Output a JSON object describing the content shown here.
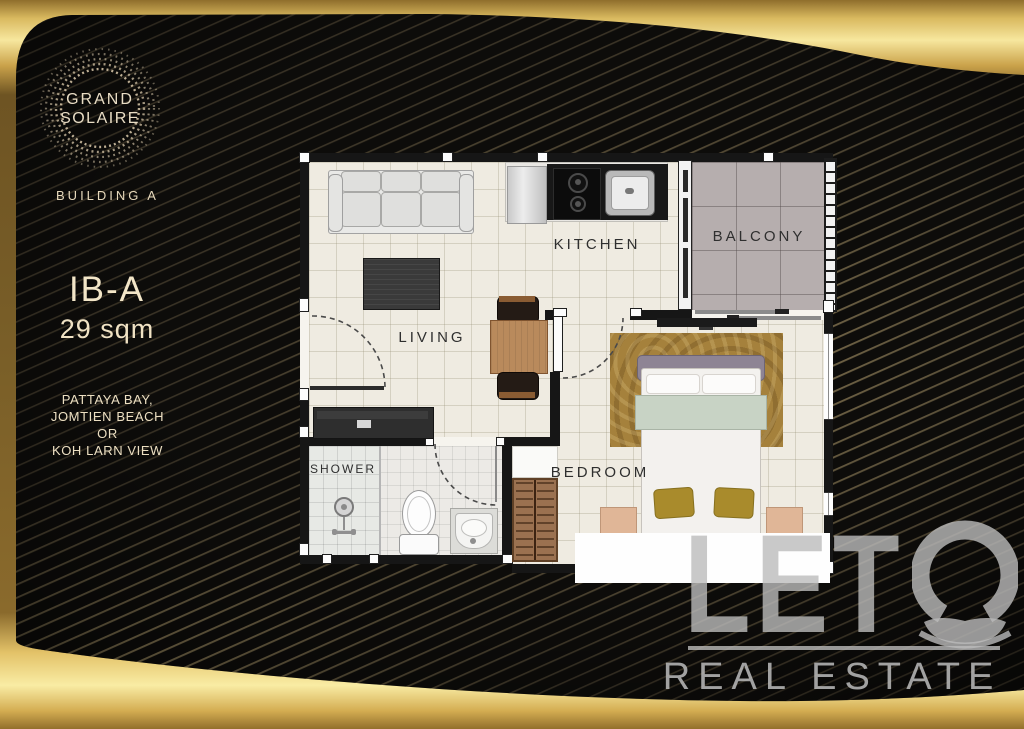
{
  "brand": {
    "logo": {
      "line1": "GRAND",
      "line2": "SOLAIRE"
    },
    "building": "BUILDING A"
  },
  "unit": {
    "code": "IB-A",
    "area": "29 sqm",
    "view": {
      "line1": "PATTAYA BAY,",
      "line2": "JOMTIEN BEACH",
      "line3": "OR",
      "line4": "KOH LARN VIEW"
    }
  },
  "floorplan": {
    "labels": {
      "kitchen": "KITCHEN",
      "balcony": "BALCONY",
      "living": "LIVING",
      "shower": "SHOWER",
      "bedroom": "BEDROOM"
    }
  },
  "watermark": {
    "name": "LETO",
    "name_letters": "LET",
    "tagline": "REAL ESTATE"
  },
  "colors": {
    "gold_bright": "#f7e79e",
    "gold_mid": "#d9b95f",
    "gold_dark": "#8f6e2c",
    "panel_dark": "#0d0c0a",
    "cream_text": "#ead9ba",
    "floor_cream": "#efebe1",
    "balcony_tile": "#b6aeae",
    "watermark_gray": "#bcbcbc"
  }
}
